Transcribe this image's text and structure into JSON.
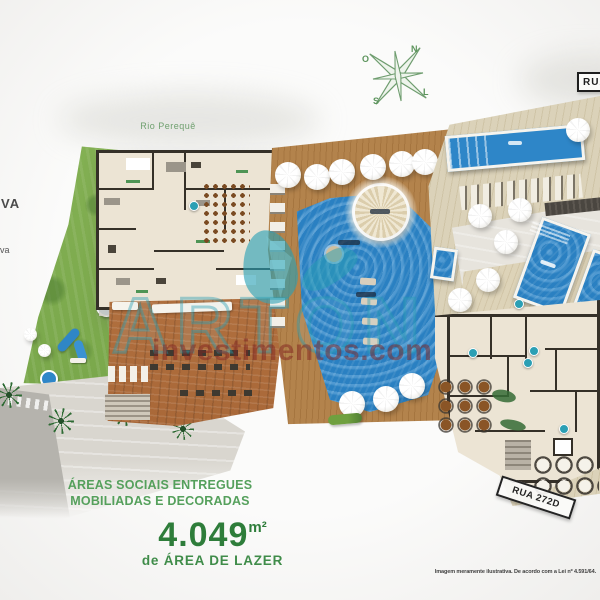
{
  "compass": {
    "n": "N",
    "l": "L",
    "s": "S",
    "o": "O"
  },
  "labels": {
    "river": "Rio Perequê",
    "street_top": "RUA",
    "street_right": "RUA 272D",
    "edge_upper": "VA",
    "edge_lower": "va"
  },
  "headline": {
    "line1": "ÁREAS SOCIAIS ENTREGUES",
    "line2": "MOBILIADAS E DECORADAS"
  },
  "area": {
    "value": "4.049",
    "unit": "m²",
    "caption": "de ÁREA DE LAZER"
  },
  "watermark": {
    "brand": "ARTON",
    "site": "investimentos.com"
  },
  "disclaimer": "Imagem meramente ilustrativa. De acordo com a Lei nº 4.591/64.",
  "colors": {
    "heading_green": "#55a05c",
    "accent_green": "#2e7d3a",
    "water_blue": "#2e86c8",
    "watermark_teal": "#2aa7b8",
    "deck_brown": "#b1824b"
  }
}
